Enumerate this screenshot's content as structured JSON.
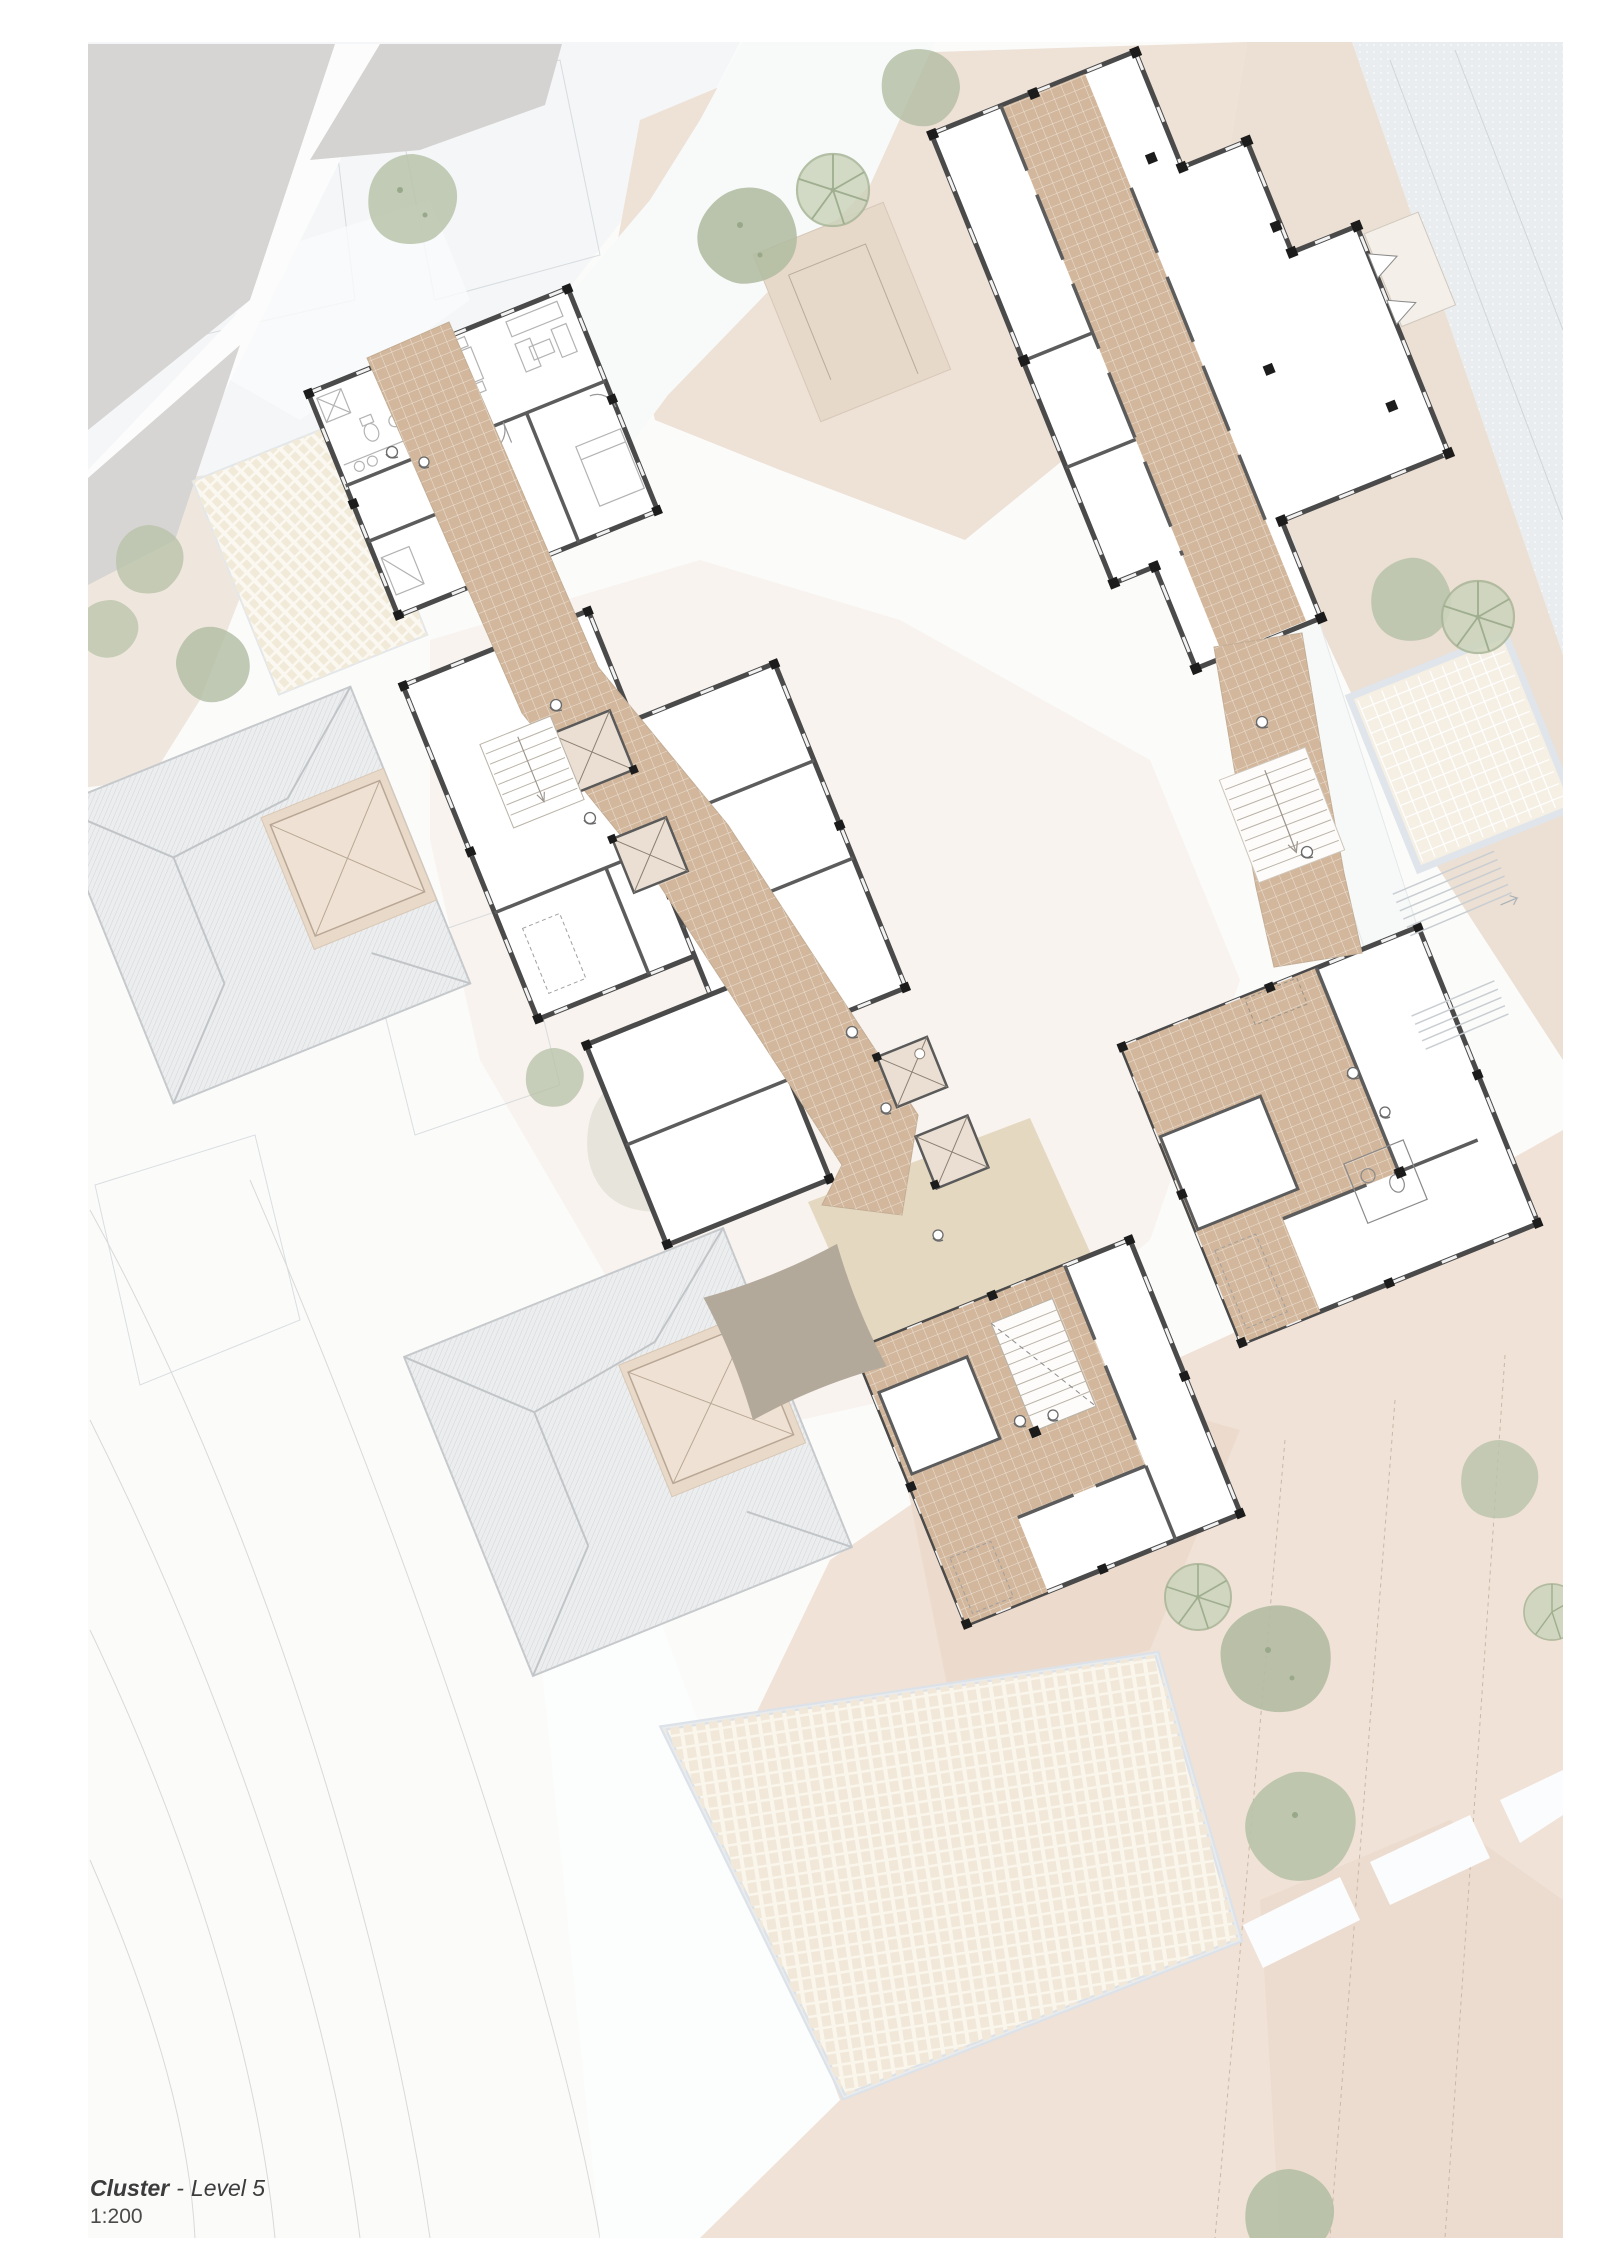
{
  "title_block": {
    "project": "Cluster",
    "separator": "-",
    "level": "Level 5",
    "scale": "1:200"
  },
  "palette": {
    "page_background": "#ffffff",
    "terrain_pink": "#eee1d5",
    "terrain_beige_court": "#e7d9ca",
    "slope_gray_blue": "#e9edef",
    "neighbor_roof_gray": "#d5d4d2",
    "hip_roof_fill": "#ebedee",
    "roof_hatch_line": "#d2d5d7",
    "wall_dark": "#4a4a4a",
    "column_black": "#1c1c1c",
    "tile_floor_tan": "#d2b79c",
    "deck_beige": "#e5d8c1",
    "canopy_taupe": "#b3a99b",
    "plaza_cream": "#faf6ec",
    "plaza_border_blue": "#dce2e8",
    "tree_sage": "#b9c3aa",
    "tree_ring_green": "#a8b596",
    "contour_gray": "#d9d9d9"
  }
}
